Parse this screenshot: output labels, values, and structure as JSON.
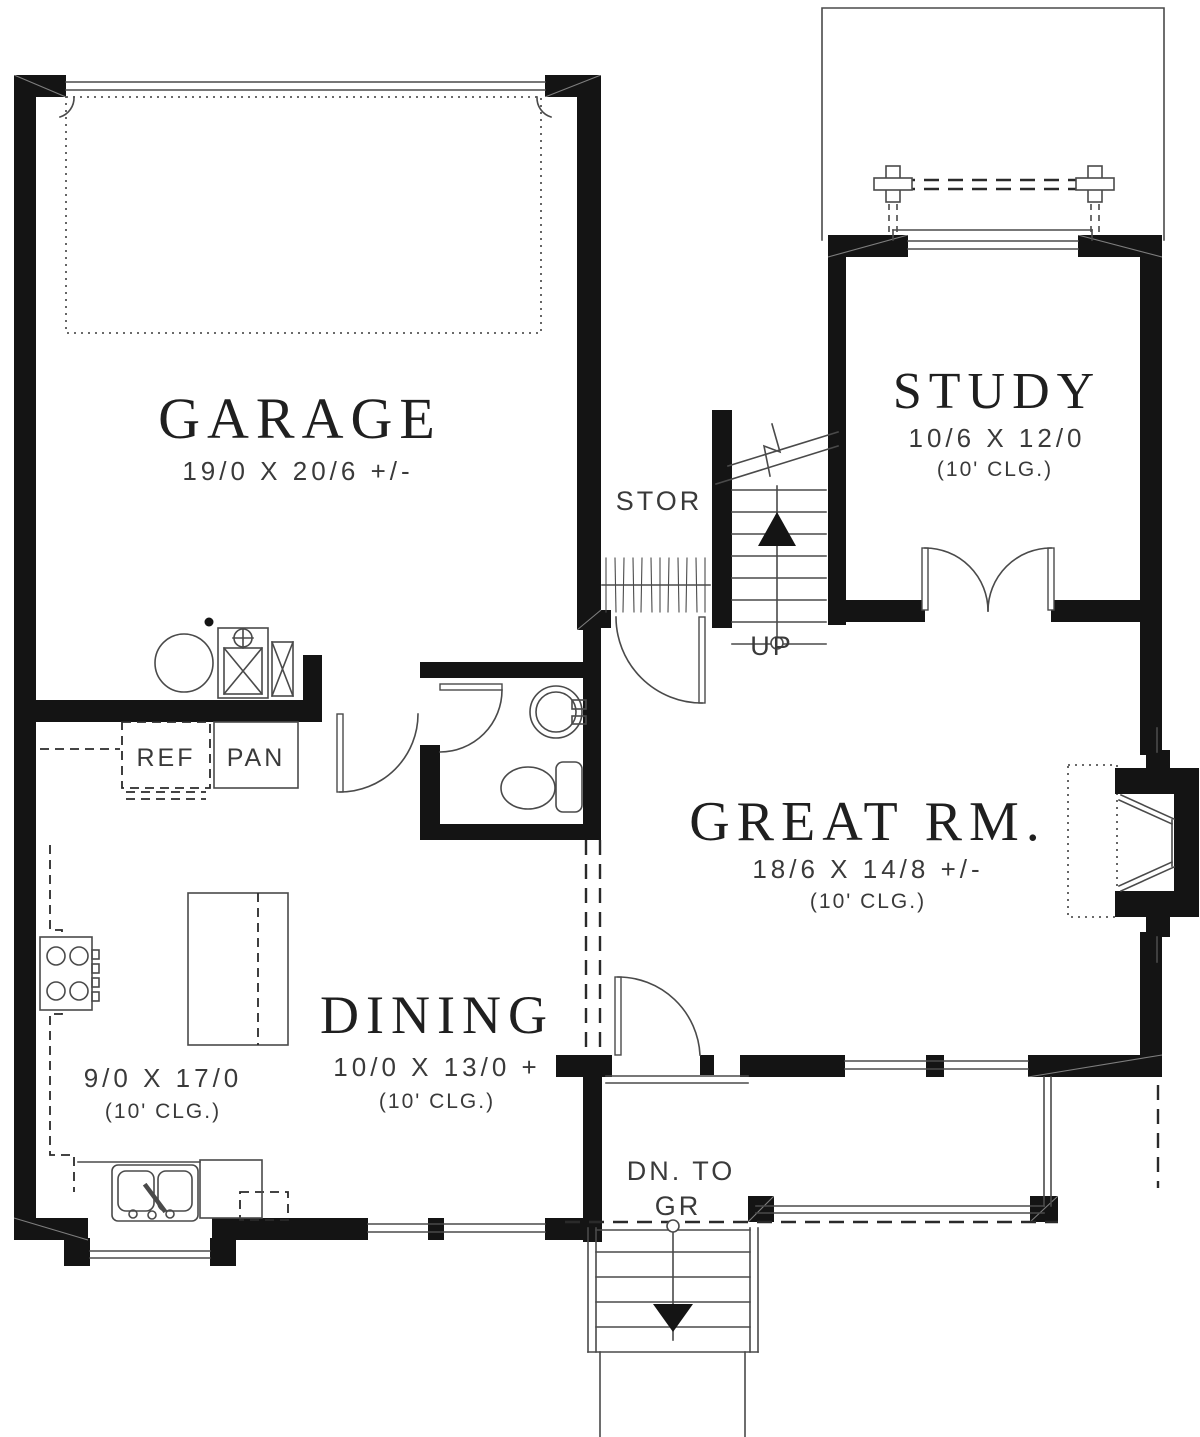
{
  "page": {
    "background": "#ffffff"
  },
  "colors": {
    "wall": "#141414",
    "thin_line": "#4a4a4a",
    "dashed_line": "#2a2a2a",
    "room_text": "#1f1f1f",
    "dim_text": "#3a3a3a"
  },
  "rooms": {
    "garage": {
      "name": "GARAGE",
      "dims": "19/0 X 20/6 +/-"
    },
    "study": {
      "name": "STUDY",
      "dims": "10/6 X 12/0",
      "ceiling": "(10' CLG.)"
    },
    "great_room": {
      "name": "GREAT RM.",
      "dims": "18/6 X 14/8 +/-",
      "ceiling": "(10' CLG.)"
    },
    "dining": {
      "name": "DINING",
      "dims": "10/0 X 13/0 +",
      "ceiling": "(10' CLG.)"
    },
    "kitchen": {
      "dims": "9/0 X 17/0",
      "ceiling": "(10' CLG.)"
    }
  },
  "annotations": {
    "storage": "STOR",
    "stairs_up": "UP",
    "stairs_down_line1": "DN. TO",
    "stairs_down_line2": "GR",
    "refrigerator": "REF",
    "pantry": "PAN"
  }
}
